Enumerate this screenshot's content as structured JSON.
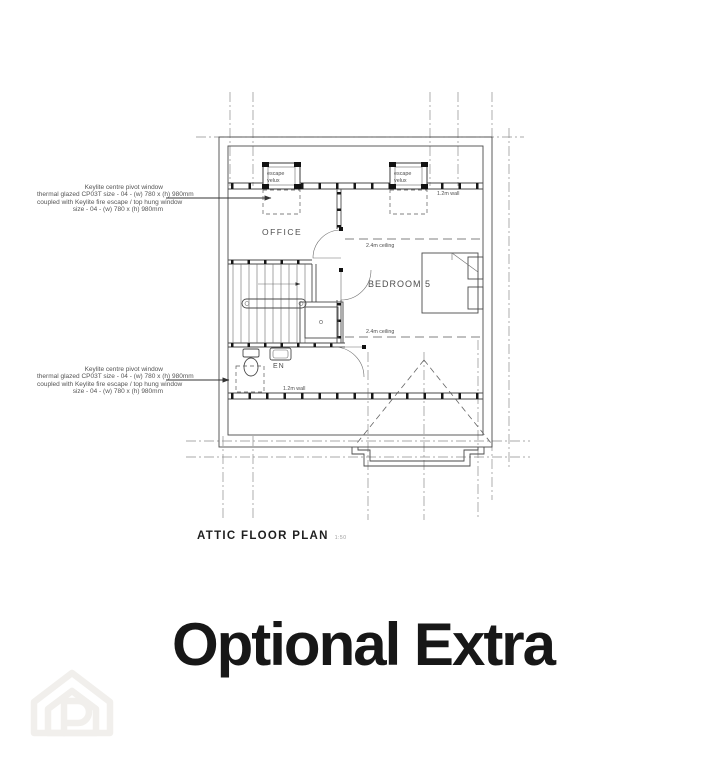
{
  "plan": {
    "title": "ATTIC FLOOR PLAN",
    "scale": "1:50",
    "room_labels": {
      "office": "OFFICE",
      "bedroom": "BEDROOM 5",
      "ensuite": "EN"
    },
    "ceiling_label_top": "2.4m ceiling",
    "ceiling_label_bottom": "2.4m ceiling",
    "wall_label_top": "1.2m wall",
    "wall_label_bottom": "1.2m wall",
    "velux_left": {
      "line1": "escape",
      "line2": "velux"
    },
    "velux_right": {
      "line1": "escape",
      "line2": "velux"
    },
    "annotation_top": {
      "lines": [
        "Keylite centre pivot window",
        "thermal glazed CP03T size - 04 - (w) 780 x (h) 980mm",
        "coupled with Keylite fire escape / top hung window",
        "size - 04 - (w) 780 x (h) 980mm"
      ]
    },
    "annotation_bottom": {
      "lines": [
        "Keylite centre pivot window",
        "thermal glazed CP03T size - 04 - (w) 780 x (h) 980mm",
        "coupled with Keylite fire escape / top hung window",
        "size - 04 - (w) 780 x (h) 980mm"
      ]
    }
  },
  "caption": "Optional Extra",
  "watermark": {
    "name": "house-p-logo"
  },
  "colors": {
    "ink": "#4a4a4a",
    "grid": "#8d8d8d",
    "title": "#1f1f1f",
    "caption": "#171717",
    "watermark": "#f1efec"
  }
}
